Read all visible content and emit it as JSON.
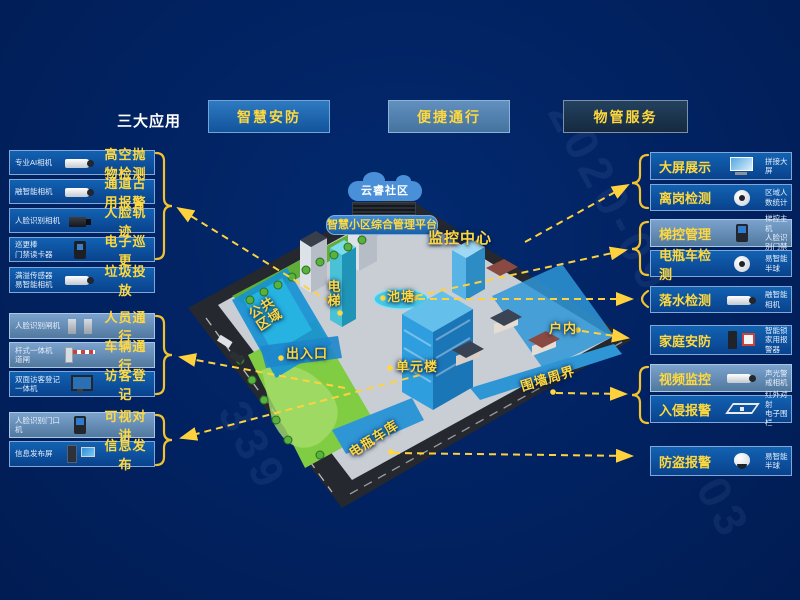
{
  "header": {
    "title": "三大应用",
    "buttons": [
      {
        "label": "智慧安防"
      },
      {
        "label": "便捷通行"
      },
      {
        "label": "物管服务"
      }
    ]
  },
  "left_panel": {
    "items": [
      {
        "device": "专业AI相机",
        "label": "高空抛物检测",
        "icon": "bullet-camera"
      },
      {
        "device": "融智能相机",
        "label": "通道占用报警",
        "icon": "bullet-camera"
      },
      {
        "device": "人脸识别相机",
        "label": "人脸轨迹",
        "icon": "box-camera"
      },
      {
        "device": "巡更棒\n门禁读卡器",
        "label": "电子巡更",
        "icon": "card-reader"
      },
      {
        "device": "满溢传感器\n易智能相机",
        "label": "垃圾投放",
        "icon": "bullet-camera"
      },
      {
        "device": "人脸识别闸机",
        "label": "人员通行",
        "icon": "turnstile"
      },
      {
        "device": "杆式一体机\n道闸",
        "label": "车辆通行",
        "icon": "barrier-gate"
      },
      {
        "device": "双面访客登记\n一体机",
        "label": "访客登记",
        "icon": "visitor-kiosk"
      },
      {
        "device": "人脸识别门口机",
        "label": "可视对讲",
        "icon": "door-station"
      },
      {
        "device": "信息发布屏",
        "label": "信息发布",
        "icon": "info-screen"
      }
    ]
  },
  "right_panel": {
    "items": [
      {
        "label": "大屏展示",
        "device": "拼接大屏",
        "icon": "video-wall"
      },
      {
        "label": "离岗检测",
        "device": "区域人数统计",
        "icon": "dome-camera"
      },
      {
        "label": "梯控管理",
        "device": "梯控主机\n人脸识别门禁",
        "icon": "access-panel"
      },
      {
        "label": "电瓶车检测",
        "device": "易智能半球",
        "icon": "dome-camera"
      },
      {
        "label": "落水检测",
        "device": "融智能相机",
        "icon": "bullet-camera"
      },
      {
        "label": "家庭安防",
        "device": "智能锁\n家用报警器",
        "icon": "smart-lock-alarm"
      },
      {
        "label": "视频监控",
        "device": "声光警戒相机",
        "icon": "bullet-camera"
      },
      {
        "label": "入侵报警",
        "device": "红外对射\n电子围栏",
        "icon": "perimeter-fence"
      },
      {
        "label": "防盗报警",
        "device": "易智能半球",
        "icon": "turret-camera"
      }
    ]
  },
  "map": {
    "labels": {
      "cloud": "云睿社区",
      "platform": "智慧小区综合管理平台",
      "monitor_center": "监控中心",
      "elevator": "电\n梯",
      "pond": "池塘",
      "public_area": "公共\n区域",
      "entrance": "出入口",
      "unit_building": "单元楼",
      "indoor": "户内",
      "perimeter": "围墙周界",
      "bike_garage": "电瓶车库"
    }
  },
  "watermark": {
    "texts": [
      "2020-09",
      "339",
      "03"
    ]
  },
  "colors": {
    "background": "#01215f",
    "accent_yellow": "#ffd83d",
    "row_blue": "#0f4f9d",
    "row_light_blue": "#6e97c2",
    "zone_blue": "#2f96d6"
  }
}
